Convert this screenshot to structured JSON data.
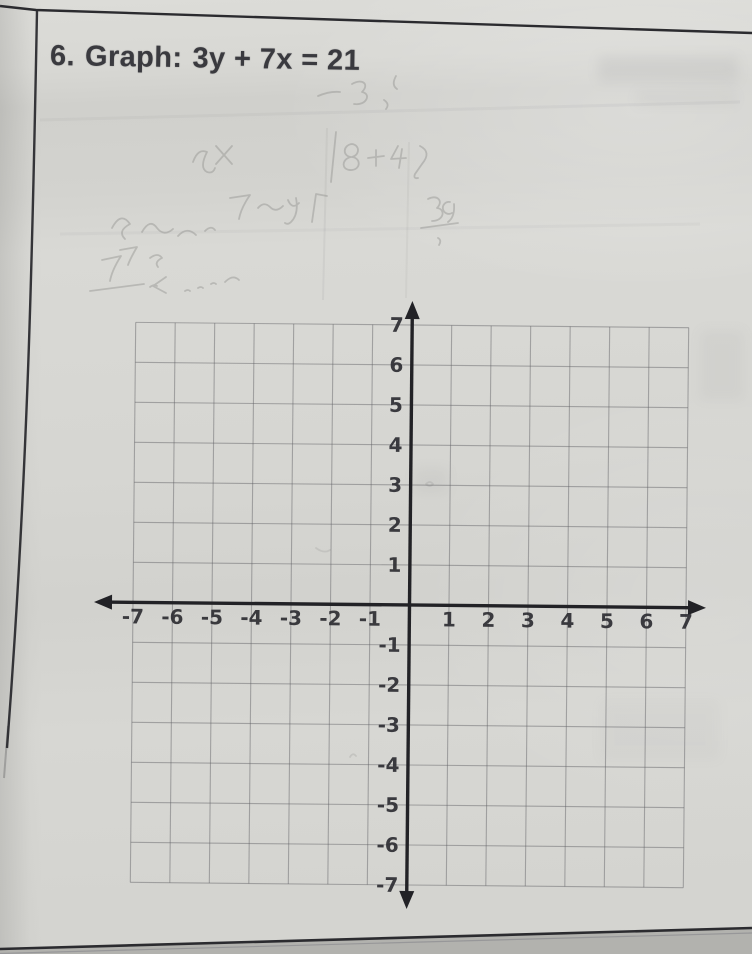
{
  "problem": {
    "number": "6.",
    "instruction": "Graph:",
    "equation": "3y + 7x = 21"
  },
  "graph": {
    "x_range": [
      -7,
      7
    ],
    "y_range": [
      -7,
      7
    ],
    "cells_per_axis": 14,
    "x_ticks_negative": [
      "-7",
      "-6",
      "-5",
      "-4",
      "-3",
      "-2",
      "-1"
    ],
    "x_ticks_positive": [
      "1",
      "2",
      "3",
      "4",
      "5",
      "6",
      "7"
    ],
    "y_ticks_positive": [
      "7",
      "6",
      "5",
      "4",
      "3",
      "2",
      "1"
    ],
    "y_ticks_negative": [
      "-1",
      "-2",
      "-3",
      "-4",
      "-5",
      "-6",
      "-7"
    ],
    "plotted_content": "empty grid - no line drawn yet"
  },
  "annotations": {
    "pencil_marks": "faint erased handwritten pencil work above the grid (illegible)",
    "ink_ghosting": "faint show-through of printing near the top-right of the page"
  },
  "colors": {
    "paper": "#d6d6d2",
    "ink": "#3a3a3f",
    "axis": "#222226",
    "grid_line": "#5e5e62",
    "tick_label": "#2d2d32",
    "pencil": "#8e8e8a",
    "page_border": "#2b2b2f"
  }
}
